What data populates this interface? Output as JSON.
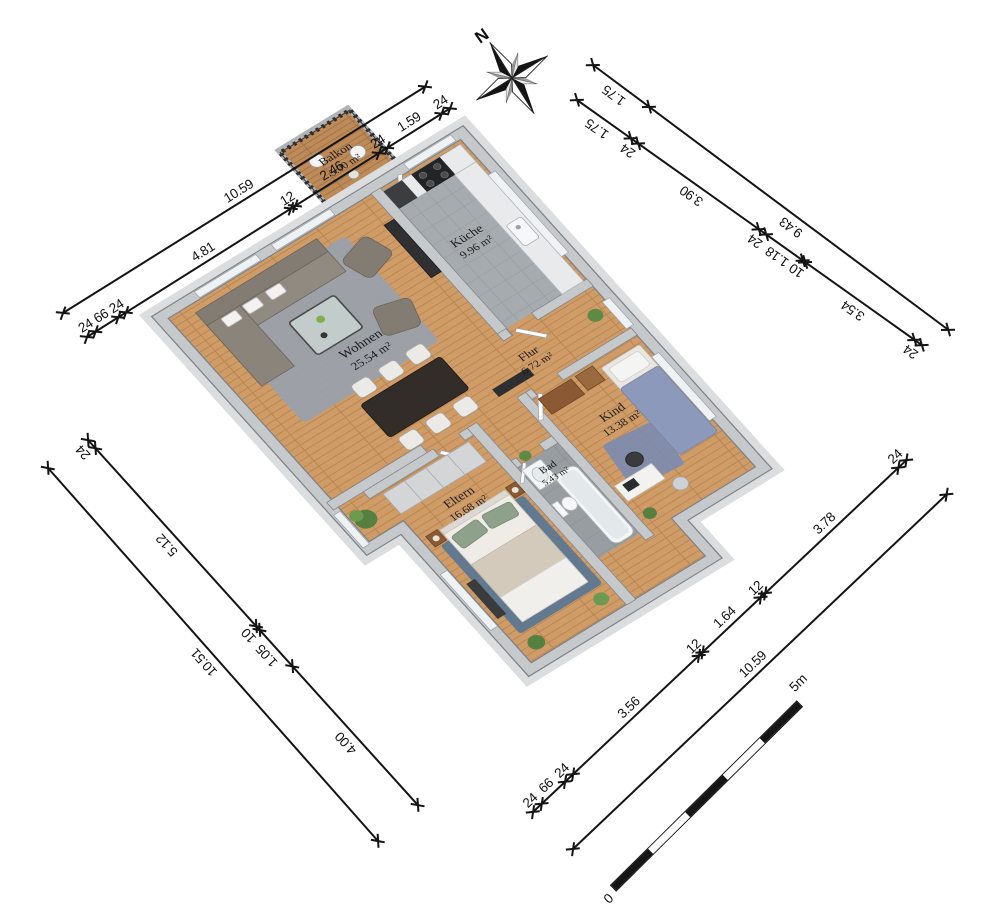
{
  "compass": {
    "north_label": "N"
  },
  "rooms": [
    {
      "name": "Balkon",
      "area": "5.00 m²"
    },
    {
      "name": "Küche",
      "area": "9.96 m²"
    },
    {
      "name": "Wohnen",
      "area": "25.54 m²"
    },
    {
      "name": "Flur",
      "area": "6.72 m²"
    },
    {
      "name": "Kind",
      "area": "13.38 m²"
    },
    {
      "name": "Bad",
      "area": "5.43 m²"
    },
    {
      "name": "Eltern",
      "area": "16.68 m²"
    }
  ],
  "dimensions": {
    "top_left_outer": {
      "segments": [
        "10.59"
      ]
    },
    "top_left_inner": {
      "segments": [
        "24",
        "66",
        "24",
        "4.81",
        "12",
        "2.46",
        "24",
        "1.59",
        "24"
      ]
    },
    "top_right_outer": {
      "segments": [
        "1.75",
        "9.43"
      ]
    },
    "top_right_inner": {
      "segments": [
        "1.75",
        "24",
        "3.90",
        "24",
        "1.18",
        "10",
        "3.54",
        "24"
      ]
    },
    "bottom_left_outer": {
      "segments": [
        "10.51"
      ]
    },
    "bottom_left_inner": {
      "segments": [
        "24",
        "5.12",
        "10",
        "1.05",
        "4.00"
      ]
    },
    "bottom_right_outer": {
      "segments": [
        "10.59"
      ]
    },
    "bottom_right_inner": {
      "segments": [
        "24",
        "66",
        "24",
        "3.56",
        "12",
        "1.64",
        "12",
        "3.78",
        "24"
      ]
    }
  },
  "scale_bar": {
    "start_label": "0",
    "end_label": "5m"
  }
}
